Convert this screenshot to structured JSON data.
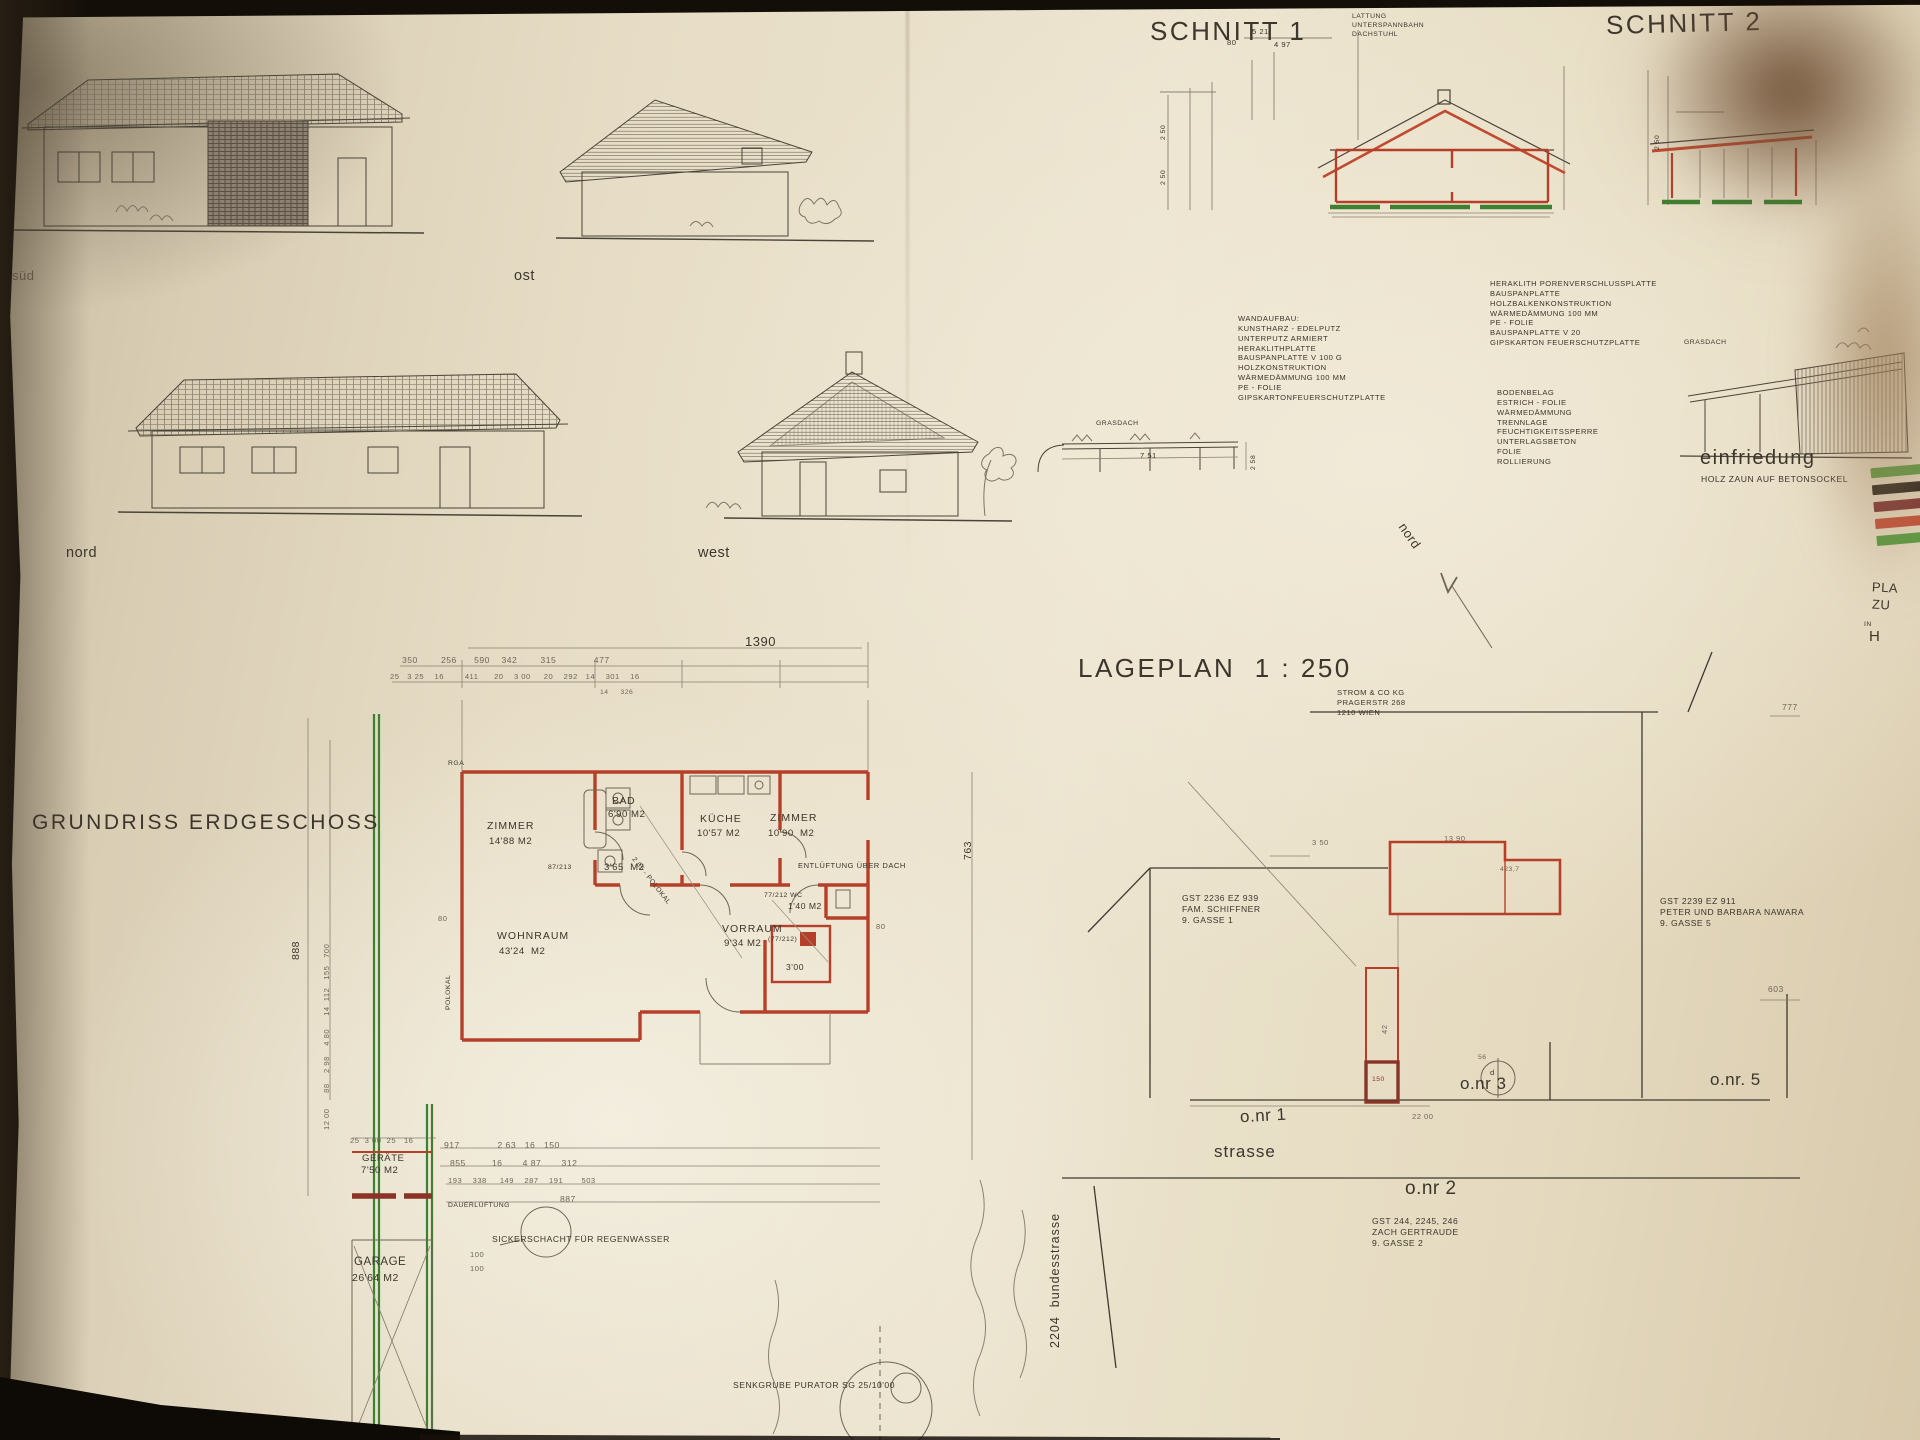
{
  "elevations": {
    "sued_label": "süd",
    "ost_label": "ost",
    "nord_label": "nord",
    "west_label": "west"
  },
  "sections": {
    "schnitt1_title": "SCHNITT 1",
    "schnitt2_title": "SCHNITT 2",
    "roof_note": [
      "LATTUNG",
      "UNTERSPANNBAHN",
      "DACHSTUHL"
    ],
    "dims": {
      "d80": "80",
      "d521": "5 21",
      "d497": "4 97",
      "d250": "2 50"
    },
    "grasdach_label": "GRASDACH",
    "grasdach_dims": {
      "d751": "7 51",
      "d258": "2 58"
    }
  },
  "notes": {
    "wandaufbau": [
      "WANDAUFBAU:",
      "KUNSTHARZ - EDELPUTZ",
      "UNTERPUTZ ARMIERT",
      "HERAKLITHPLATTE",
      "BAUSPANPLATTE V 100 G",
      "HOLZKONSTRUKTION",
      "WÄRMEDÄMMUNG 100 MM",
      "PE - FOLIE",
      "GIPSKARTONFEUERSCHUTZPLATTE"
    ],
    "deckenaufbau": [
      "HERAKLITH PORENVERSCHLUSSPLATTE",
      "BAUSPANPLATTE",
      "HOLZBALKENKONSTRUKTION",
      "WÄRMEDÄMMUNG 100 MM",
      "PE - FOLIE",
      "BAUSPANPLATTE V 20",
      "GIPSKARTON FEUERSCHUTZPLATTE"
    ],
    "bodenaufbau": [
      "BODENBELAG",
      "ESTRICH - FOLIE",
      "WÄRMEDÄMMUNG",
      "TRENNLAGE",
      "FEUCHTIGKEITSSPERRE",
      "UNTERLAGSBETON",
      "FOLIE",
      "ROLLIERUNG"
    ]
  },
  "einfriedung": {
    "title": "einfriedung",
    "subtitle": "HOLZ ZAUN AUF BETONSOCKEL",
    "legend_colors": [
      "#5a9b42",
      "#2b241d",
      "#7d3434",
      "#c35038",
      "#5a9b42"
    ]
  },
  "title_block": {
    "l1": "PLA",
    "l2": "ZU",
    "l3": "IN",
    "l4": "H"
  },
  "grundriss": {
    "title": "GRUNDRISS ERDGESCHOSS",
    "rga": "RGA",
    "rooms": {
      "zimmer1": {
        "name": "ZIMMER",
        "area": "14'88 M2"
      },
      "bad": {
        "name": "BAD",
        "area": "6'90 M2"
      },
      "gang_area": "3'65  M2",
      "kueche": {
        "name": "KÜCHE",
        "area": "10'57 M2"
      },
      "zimmer2": {
        "name": "ZIMMER",
        "area": "10'90  M2"
      },
      "wohnraum": {
        "name": "WOHNRAUM",
        "area": "43'24  M2"
      },
      "vorraum": {
        "name": "VORRAUM",
        "area": "9'34 M2"
      },
      "wc": {
        "tag": "77/212 WC",
        "area": "1'40 M2"
      },
      "abstell_area": "3'00",
      "geraete": {
        "name": "GERÄTE",
        "area": "7'50 M2"
      },
      "garage": {
        "name": "GARAGE",
        "area": "26'64 M2"
      }
    },
    "annotations": {
      "entlueftung": "ENTLÜFTUNG ÜBER DACH",
      "dauerlueftung": "DAUERLÜFTUNG",
      "sickerschacht": "SICKERSCHACHT FÜR REGENWASSER",
      "senkgrube": "SENKGRUBE PURATOR SG 25/10'00",
      "polokal_v": "POLOKAL",
      "polokal_d": "2 05 - POLOKAL",
      "door_tag1": "87/213",
      "door_tag2": "(77/212)"
    },
    "dims": {
      "overall_top": "1390",
      "top_chain": "350        256      590    342        315             477",
      "top_chain2": "25   3 25    16        411      20    3 00     20    292   14    301    16",
      "top_chain3": "14     326",
      "left_overall": "888",
      "left_chain": "12 00      88    2 98    4 80     14  112   155   700",
      "right_overall": "763",
      "bottom1": "917             2 63   16   150",
      "bottom2": "855         16       4 87       312",
      "bottom3": "193    338     149    287    191       503",
      "bottom4": "887",
      "geraete_top": "25  3 00  25   16",
      "d100a": "100",
      "d100b": "100",
      "d80l": "80",
      "d80r": "80"
    }
  },
  "lageplan": {
    "title": "LAGEPLAN  1 : 250",
    "nord": "nord",
    "utility": [
      "STROM & CO KG",
      "PRAGERSTR 268",
      "1210 WIEN"
    ],
    "parcel_left": [
      "GST 2236 EZ 939",
      "FAM. SCHIFFNER",
      "9. GASSE 1"
    ],
    "parcel_right": [
      "GST 2239  EZ 911",
      "PETER UND BARBARA NAWARA",
      "9. GASSE 5"
    ],
    "parcel_bottom": [
      "GST 244, 2245, 246",
      "ZACH GERTRAUDE",
      "9. GASSE 2"
    ],
    "onr1": "o.nr 1",
    "onr3": "o.nr 3",
    "onr5": "o.nr. 5",
    "onr2": "o.nr 2",
    "strasse": "strasse",
    "bundesstrasse": "2204  bundesstrasse",
    "dims": {
      "d777": "777",
      "d2200": "22 00",
      "d603": "603",
      "d350": "3 50",
      "d1390": "13 90",
      "d42": "42",
      "d4237": "423,7",
      "d56": "56",
      "d150": "150",
      "dd": "d"
    }
  }
}
